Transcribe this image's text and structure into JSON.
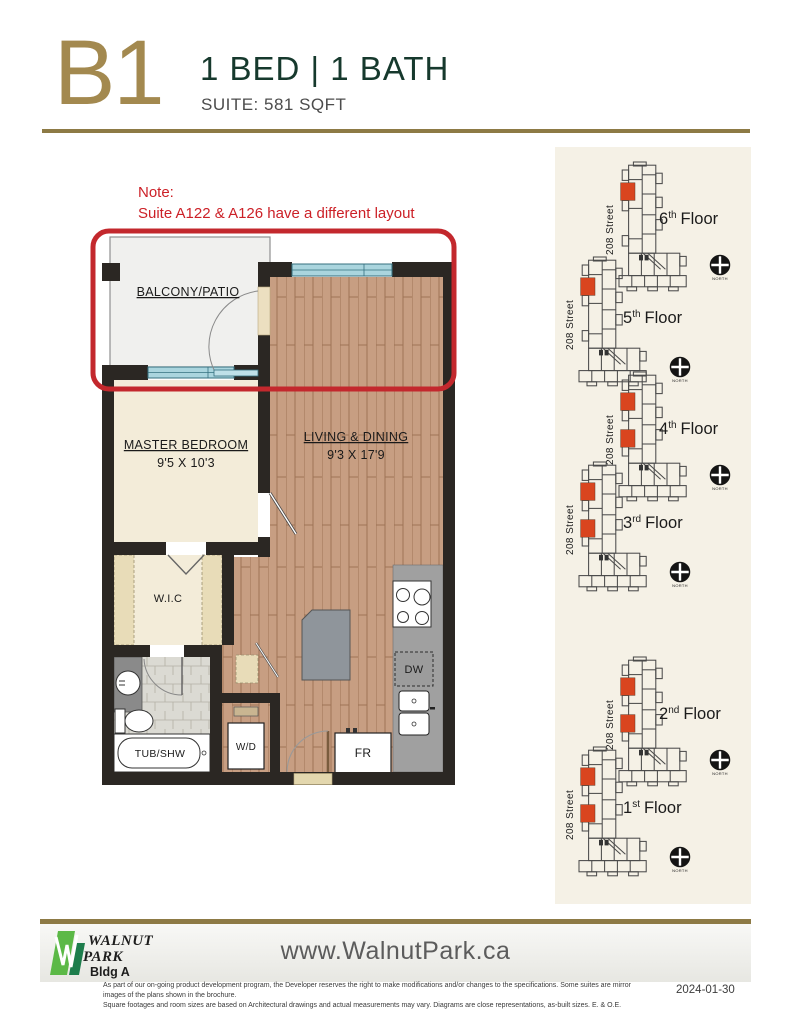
{
  "header": {
    "plan_code": "B1",
    "title": "1 BED  |  1 BATH",
    "subtitle": "SUITE: 581 SQFT"
  },
  "note": {
    "label": "Note:",
    "text": "Suite A122 & A126 have a different layout"
  },
  "floorplan": {
    "rooms": {
      "balcony": "BALCONY/PATIO",
      "master_bedroom": "MASTER BEDROOM",
      "master_bedroom_dim": "9'5 X 10'3",
      "living_dining": "LIVING & DINING",
      "living_dining_dim": "9'3 X 17'9",
      "wic": "W.I.C",
      "tub": "TUB/SHW",
      "wd": "W/D",
      "fridge": "FR",
      "dishwasher": "DW"
    }
  },
  "sidebar": {
    "street_label": "208 Street",
    "north_label": "NORTH",
    "floors": [
      {
        "num": "6",
        "suffix": "th",
        "word": "Floor",
        "units": "1"
      },
      {
        "num": "5",
        "suffix": "th",
        "word": "Floor",
        "units": "1"
      },
      {
        "num": "4",
        "suffix": "th",
        "word": "Floor",
        "units": "2"
      },
      {
        "num": "3",
        "suffix": "rd",
        "word": "Floor",
        "units": "2"
      },
      {
        "num": "2",
        "suffix": "nd",
        "word": "Floor",
        "units": "2"
      },
      {
        "num": "1",
        "suffix": "st",
        "word": "Floor",
        "units": "2"
      }
    ]
  },
  "footer": {
    "logo_line1": "WALNUT",
    "logo_line2": "PARK",
    "building": "Bldg A",
    "website": "www.WalnutPark.ca",
    "disclaimer_line1": "As part of our on-going product development program, the Developer reserves the right to make modifications and/or changes to the specifications. Some suites are mirror images of the plans shown in the brochure.",
    "disclaimer_line2": "Square footages and room sizes are based on Architectural drawings and actual measurements may vary. Diagrams are close representations, as-built sizes. E. & O.E.",
    "date": "2024-01-30"
  },
  "colors": {
    "gold": "#8d7a45",
    "plan_code_gold": "#a3894f",
    "dark_green": "#16392d",
    "note_red": "#cc2027",
    "highlight_red": "#d9451f",
    "wall_black": "#2b2723",
    "wood": "#c79e82",
    "cream": "#f3ecd9",
    "panel_bg": "#f5f1e6",
    "window_blue": "#aad5de"
  }
}
